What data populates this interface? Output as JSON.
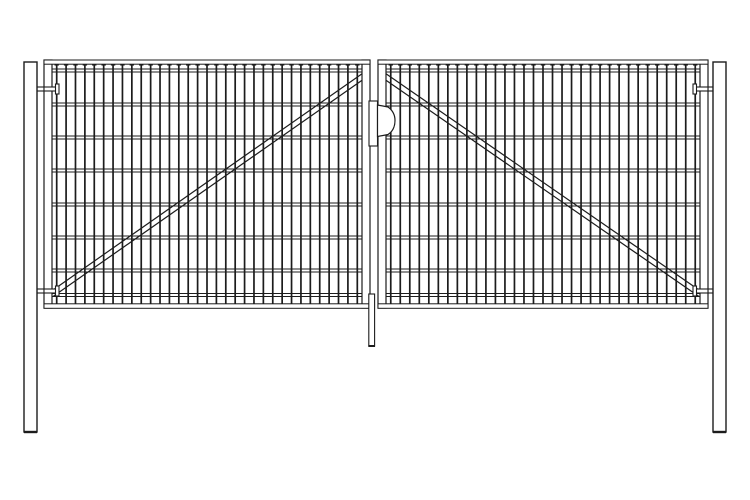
{
  "canvas": {
    "width": 750,
    "height": 500,
    "background": "#ffffff",
    "stroke_color": "#1c1c1c",
    "fill_color": "#ffffff"
  },
  "drawing": {
    "type": "technical-line-drawing",
    "subject": "double-leaf-wire-mesh-gate-front-view"
  },
  "components": {
    "posts": [
      {
        "name": "left-post",
        "x": 24,
        "y": 62,
        "width": 13,
        "height": 370
      },
      {
        "name": "right-post",
        "x": 713,
        "y": 62,
        "width": 13,
        "height": 370
      }
    ],
    "mesh": {
      "vertical_wires": 33,
      "wire_top": 65,
      "wire_bottom": 304,
      "tick_half_width": 2.2,
      "horizontal_wires_y": [
        69,
        103,
        136,
        169,
        203,
        236,
        269,
        293.5
      ],
      "band_height": 3
    },
    "leaves": [
      {
        "name": "left-gate-leaf",
        "x": 44,
        "y": 60,
        "width": 326,
        "height": 248,
        "stile_width": 8,
        "rail_height": 4.2,
        "diagonal": {
          "x1": 53,
          "y1": 290,
          "x2": 366,
          "y2": 71,
          "offset": 6.5
        }
      },
      {
        "name": "right-gate-leaf",
        "x": 378,
        "y": 60,
        "width": 330,
        "height": 248,
        "stile_width": 8,
        "rail_height": 4.2,
        "diagonal": {
          "x1": 382,
          "y1": 71,
          "x2": 699,
          "y2": 290,
          "offset": 6.5
        }
      }
    ],
    "hinges": {
      "mirror_axis": 376,
      "template": {
        "bracket": {
          "x": 31.5,
          "w": 4,
          "dy": -5.5,
          "h": 11
        },
        "pin": {
          "x": 35.5,
          "w": 8.5,
          "dy": -2,
          "h": 4
        },
        "bar": {
          "x": 44,
          "w": 14,
          "dy": -2,
          "h": 4
        },
        "cap": {
          "x": 55.5,
          "w": 3.5,
          "dy": -5,
          "h": 10
        }
      },
      "items": [
        {
          "name": "hinge-left-top",
          "side": "left",
          "y": 89
        },
        {
          "name": "hinge-left-bottom",
          "side": "left",
          "y": 291
        },
        {
          "name": "hinge-right-top",
          "side": "right",
          "y": 89
        },
        {
          "name": "hinge-right-bottom",
          "side": "right",
          "y": 291
        }
      ]
    },
    "latch": {
      "name": "latch-handle",
      "plate": {
        "x": 369,
        "y": 101,
        "width": 8.5,
        "height": 45
      },
      "grip": {
        "left": 377.5,
        "top": 105,
        "right": 395,
        "bottom": 136.5,
        "shoulder": 388,
        "mid": 120.5
      }
    },
    "drop_rod": {
      "name": "drop-rod",
      "x": 368.8,
      "y": 294,
      "width": 5.8,
      "height": 52
    }
  }
}
